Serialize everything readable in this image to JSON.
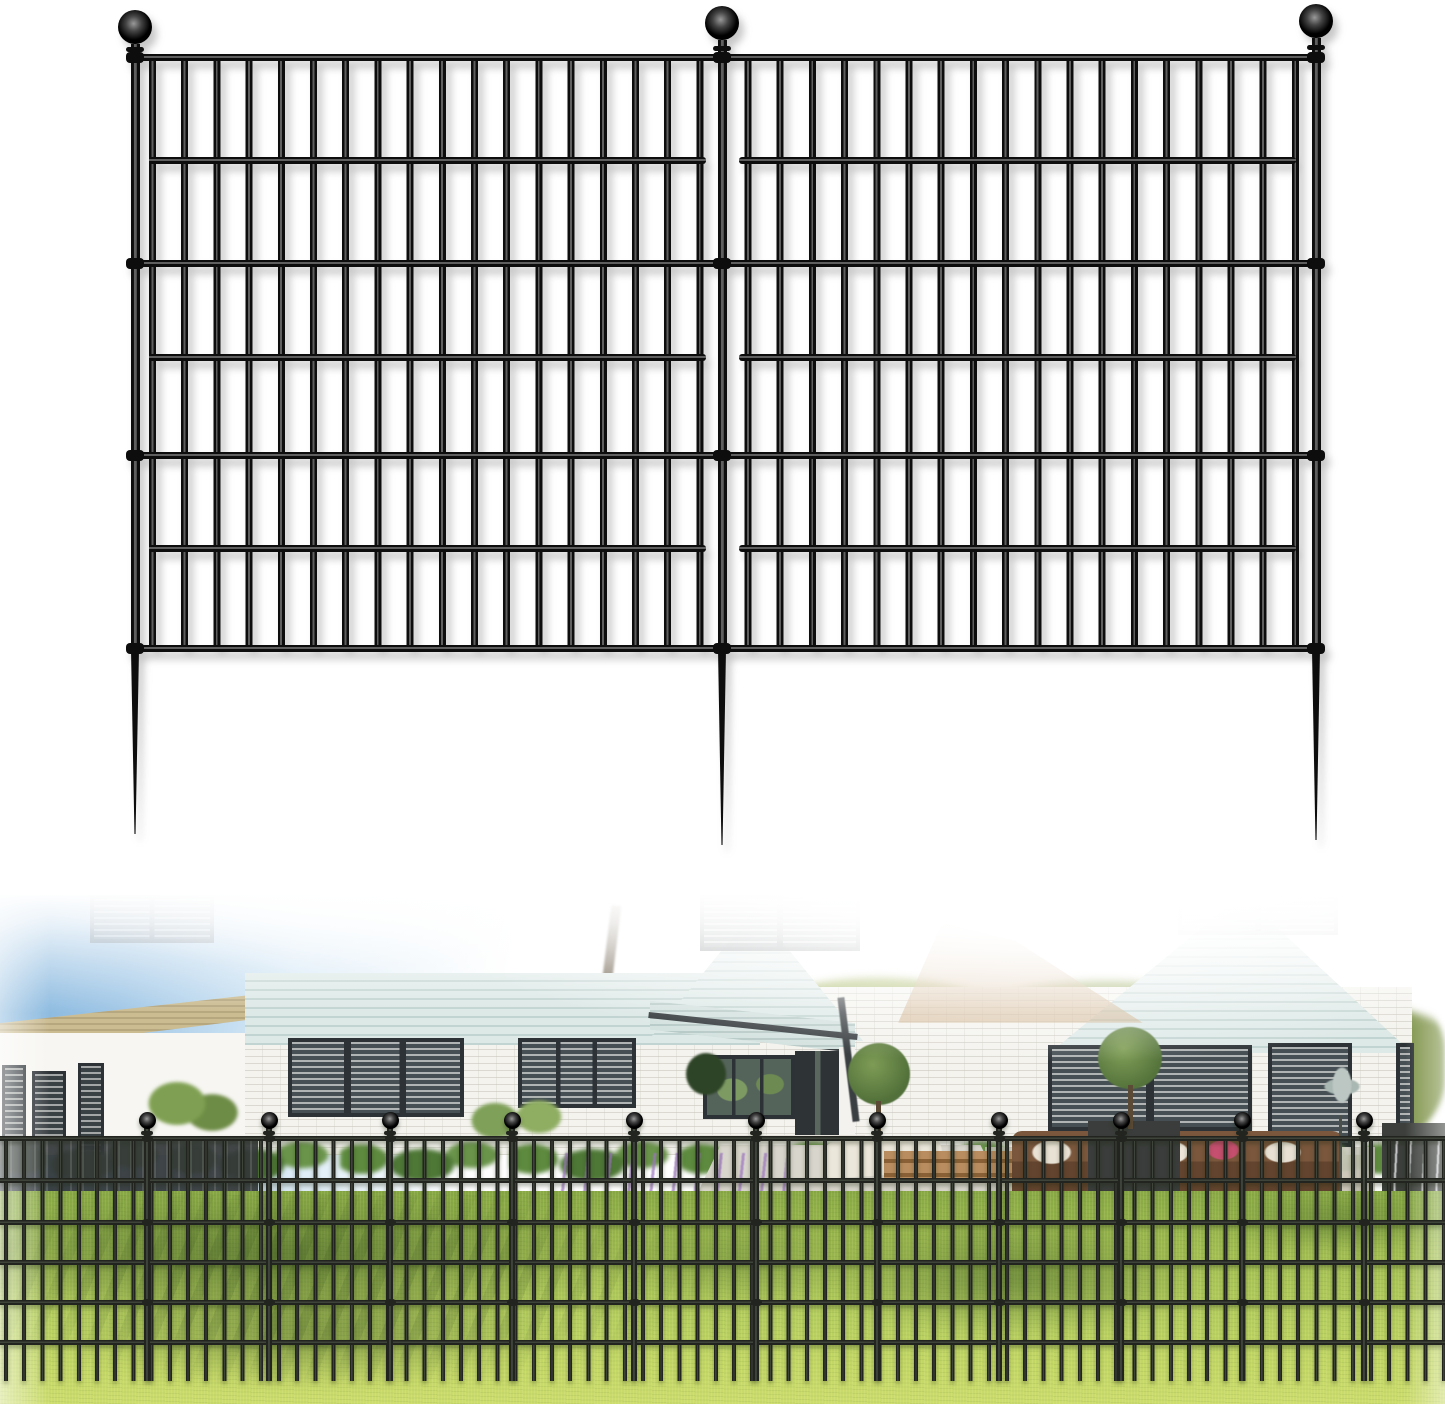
{
  "page": {
    "width": 1445,
    "height": 1404,
    "background": "#ffffff"
  },
  "product_render": {
    "metal_dark": "#0d0d0d",
    "metal_light": "#5f5f5f",
    "post_width": 9,
    "shaft_bottom": 654,
    "rail_height": 7,
    "rails_y": [
      57,
      160,
      263,
      357,
      455,
      548,
      648
    ],
    "clamp_rails": [
      0,
      2,
      4,
      6
    ],
    "bars_top": 57,
    "bars_bottom": 651,
    "bar_period": 32.2,
    "bar_width": 7,
    "panels": [
      {
        "left": 143,
        "right": 712,
        "bar_offset": 6
      },
      {
        "left": 733,
        "right": 1302,
        "bar_offset": 11.5
      }
    ],
    "posts": [
      {
        "cx": 135,
        "ball_cy": 27,
        "ball_r": 17,
        "shaft_top": 44,
        "collar_y": 47,
        "spike_tip": 834
      },
      {
        "cx": 722,
        "ball_cy": 23,
        "ball_r": 17,
        "shaft_top": 40,
        "collar_y": 46,
        "spike_tip": 845
      },
      {
        "cx": 1316,
        "ball_cy": 21,
        "ball_r": 17,
        "shaft_top": 38,
        "collar_y": 45,
        "spike_tip": 840
      }
    ],
    "clamp_w": 18,
    "clamp_h": 11
  },
  "photo_fence": {
    "metal_dark": "#22251f",
    "metal_light": "#3f443a",
    "post_width": 6,
    "shaft_bottom": 486,
    "rail_height": 5,
    "rails_y": [
      243,
      285,
      327,
      367,
      407,
      447
    ],
    "clamp_rails": [
      0,
      2,
      4
    ],
    "bars_top": 245,
    "bars_bottom": 486,
    "bar_period": 18.2,
    "bar_width": 4,
    "panels": [
      {
        "left": 0,
        "right": 1445,
        "bar_offset": 4
      }
    ],
    "rails_full_width": true,
    "posts_cx": [
      147,
      269,
      390,
      512,
      634,
      756,
      877,
      999,
      1121,
      1242,
      1364
    ],
    "ball_cy": 225,
    "ball_r": 8.5,
    "collar_y": 236,
    "shaft_top": 232,
    "clamp_w": 11,
    "clamp_h": 7
  },
  "photo_palette": {
    "sky": "#7cb0da",
    "siding": "#d9e6e4",
    "white_brick": "#f4f3ee",
    "window_frame": "#2c3236",
    "lawn_light": "#c3d765",
    "lawn_dark": "#88a944",
    "tree_sunlit": "#9db054",
    "tree_shaded": "#5d734a",
    "soil": "#6c4f33",
    "flower_pink": "#e6c7d8",
    "flower_purple": "#9d76c0",
    "sofa_wicker": "#6d4b33",
    "cushion_pink": "#d5607f"
  }
}
